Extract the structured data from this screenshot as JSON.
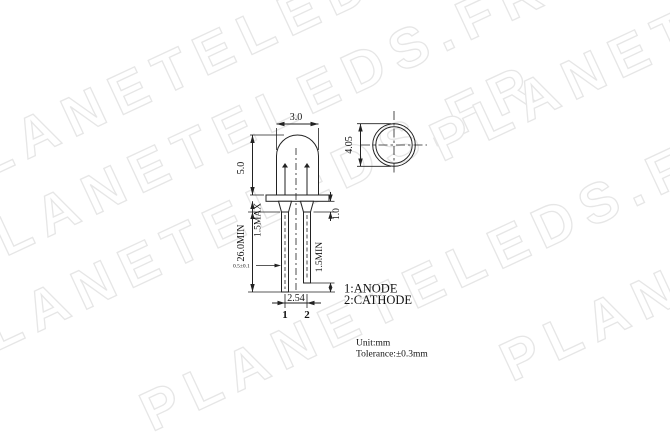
{
  "watermark": {
    "text": "PLANETELEDS.FR",
    "color": "#e6e6e6"
  },
  "colors": {
    "line": "#222222",
    "background": "#ffffff"
  },
  "side_view": {
    "dim_body_width": "3.0",
    "dim_body_height": "5.0",
    "dim_lead_length": "26.0MIN",
    "dim_standoff": "1.5MAX",
    "dim_flange_height": "1.0",
    "dim_lead_diff": "1.5MIN",
    "dim_lead_thickness": "0.5±0.1",
    "dim_pitch": "2.54",
    "pin1_label": "1",
    "pin2_label": "2"
  },
  "top_view": {
    "dim_diameter": "4.05"
  },
  "legend": {
    "anode": "1:ANODE",
    "cathode": "2:CATHODE"
  },
  "notes": {
    "unit": "Unit:mm",
    "tolerance": "Tolerance:±0.3mm"
  }
}
